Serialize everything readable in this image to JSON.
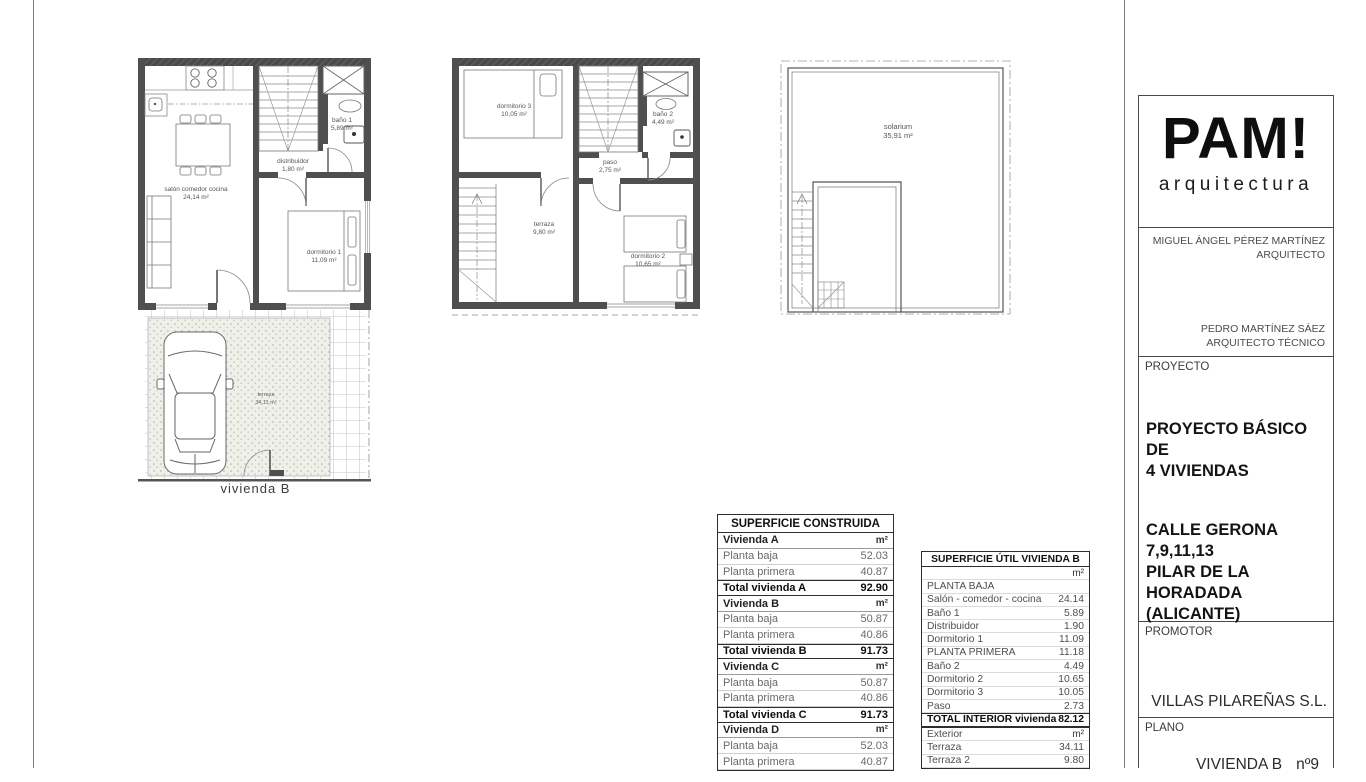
{
  "plans": {
    "planta_baja": {
      "rooms": {
        "salon": {
          "name": "salón comedor cocina",
          "area": "24,14 m²"
        },
        "distribuidor": {
          "name": "distribuidor",
          "area": "1,80 m²"
        },
        "bano1": {
          "name": "baño 1",
          "area": "5,89 m²"
        },
        "dormitorio1": {
          "name": "dormitorio 1",
          "area": "11,09 m²"
        },
        "terraza": {
          "name": "terraza",
          "area": "34,11 m²"
        }
      },
      "caption": "vivienda B"
    },
    "planta_primera": {
      "rooms": {
        "dormitorio3": {
          "name": "dormitorio 3",
          "area": "10,05 m²"
        },
        "bano2": {
          "name": "baño 2",
          "area": "4,49 m²"
        },
        "paso": {
          "name": "paso",
          "area": "2,75 m²"
        },
        "terraza": {
          "name": "terraza",
          "area": "9,80 m²"
        },
        "dormitorio2": {
          "name": "dormitorio 2",
          "area": "10,65 m²"
        }
      }
    },
    "solarium": {
      "rooms": {
        "solarium": {
          "name": "solarium",
          "area": "35,91 m²"
        }
      }
    }
  },
  "tables": {
    "construida": {
      "title": "SUPERFICIE CONSTRUIDA",
      "unit": "m²",
      "groups": [
        {
          "name": "Vivienda A",
          "rows": [
            {
              "label": "Planta baja",
              "value": "52.03"
            },
            {
              "label": "Planta primera",
              "value": "40.87"
            }
          ],
          "total_label": "Total vivienda A",
          "total": "92.90"
        },
        {
          "name": "Vivienda B",
          "rows": [
            {
              "label": "Planta baja",
              "value": "50.87"
            },
            {
              "label": "Planta primera",
              "value": "40.86"
            }
          ],
          "total_label": "Total vivienda B",
          "total": "91.73"
        },
        {
          "name": "Vivienda C",
          "rows": [
            {
              "label": "Planta baja",
              "value": "50.87"
            },
            {
              "label": "Planta primera",
              "value": "40.86"
            }
          ],
          "total_label": "Total vivienda C",
          "total": "91.73"
        },
        {
          "name": "Vivienda D",
          "rows": [
            {
              "label": "Planta baja",
              "value": "52.03"
            },
            {
              "label": "Planta primera",
              "value": "40.87"
            }
          ]
        }
      ]
    },
    "util_b": {
      "title": "SUPERFICIE ÚTIL VIVIENDA B",
      "unit": "m²",
      "rows": [
        {
          "label": "PLANTA BAJA",
          "value": ""
        },
        {
          "label": "Salón - comedor - cocina",
          "value": "24.14"
        },
        {
          "label": "Baño 1",
          "value": "5.89"
        },
        {
          "label": "Distribuidor",
          "value": "1.90"
        },
        {
          "label": "Dormitorio 1",
          "value": "11.09"
        },
        {
          "label": "PLANTA PRIMERA",
          "value": "11.18"
        },
        {
          "label": "Baño 2",
          "value": "4.49"
        },
        {
          "label": "Dormitorio 2",
          "value": "10.65"
        },
        {
          "label": "Dormitorio 3",
          "value": "10.05"
        },
        {
          "label": "Paso",
          "value": "2.73"
        }
      ],
      "total_label": "TOTAL INTERIOR vivienda",
      "total": "82.12",
      "exterior": {
        "label": "Exterior",
        "unit": "m²",
        "rows": [
          {
            "label": "Terraza",
            "value": "34.11"
          },
          {
            "label": "Terraza 2",
            "value": "9.80"
          }
        ]
      }
    }
  },
  "titleblock": {
    "logo": "PAM!",
    "logo_sub": "arquitectura",
    "architect": {
      "name": "MIGUEL ÁNGEL PÉREZ MARTÍNEZ",
      "role": "ARQUITECTO"
    },
    "technical_architect": {
      "name": "PEDRO MARTÍNEZ SÁEZ",
      "role": "ARQUITECTO TÉCNICO"
    },
    "sections": {
      "proyecto_label": "PROYECTO",
      "promotor_label": "PROMOTOR",
      "plano_label": "PLANO"
    },
    "project": {
      "line1": "PROYECTO BÁSICO DE",
      "line2": "4 VIVIENDAS",
      "address1": "CALLE GERONA",
      "address2": "7,9,11,13",
      "address3": "PILAR DE LA HORADADA",
      "address4": "(ALICANTE)"
    },
    "promotor": "VILLAS PILAREÑAS S.L.",
    "plano": {
      "name": "VIVIENDA B",
      "number": "nº9"
    }
  },
  "colors": {
    "wall": "#4f4f4f",
    "thin_line": "#777777",
    "tile_line": "#adadad",
    "stipple_bg": "#eef0e9",
    "label_text": "#555555"
  }
}
